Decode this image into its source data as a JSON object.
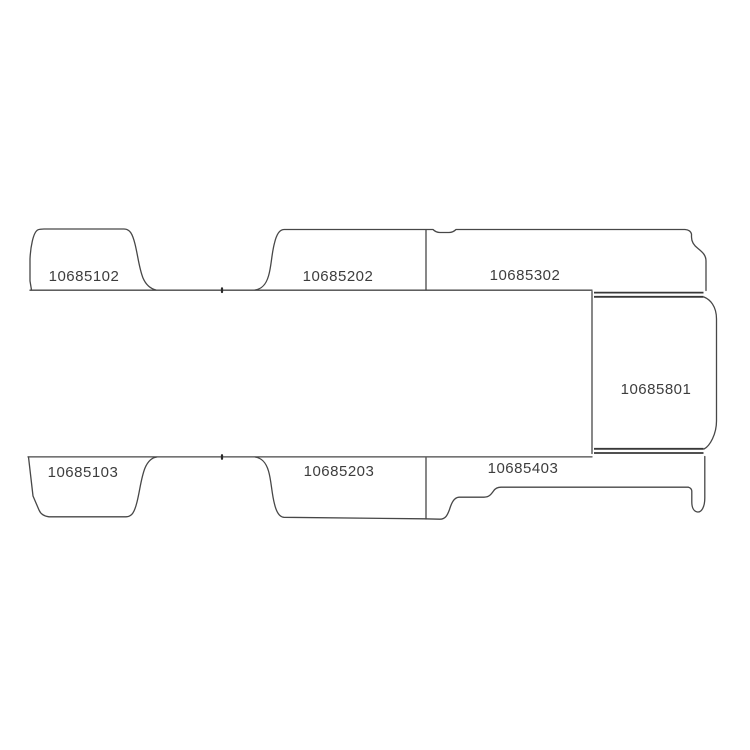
{
  "diagram": {
    "type": "vehicle-panel-parts-diagram",
    "background_color": "#ffffff",
    "line_color": "#474747",
    "rail_line_color": "#383838",
    "label_color": "#3d3d3d",
    "parts": [
      {
        "id": "10685102",
        "position": "top-row-left"
      },
      {
        "id": "10685202",
        "position": "top-row-middle"
      },
      {
        "id": "10685302",
        "position": "top-row-right"
      },
      {
        "id": "10685801",
        "position": "right-side-panel"
      },
      {
        "id": "10685103",
        "position": "bottom-row-left"
      },
      {
        "id": "10685203",
        "position": "bottom-row-middle"
      },
      {
        "id": "10685403",
        "position": "bottom-row-right"
      }
    ]
  }
}
